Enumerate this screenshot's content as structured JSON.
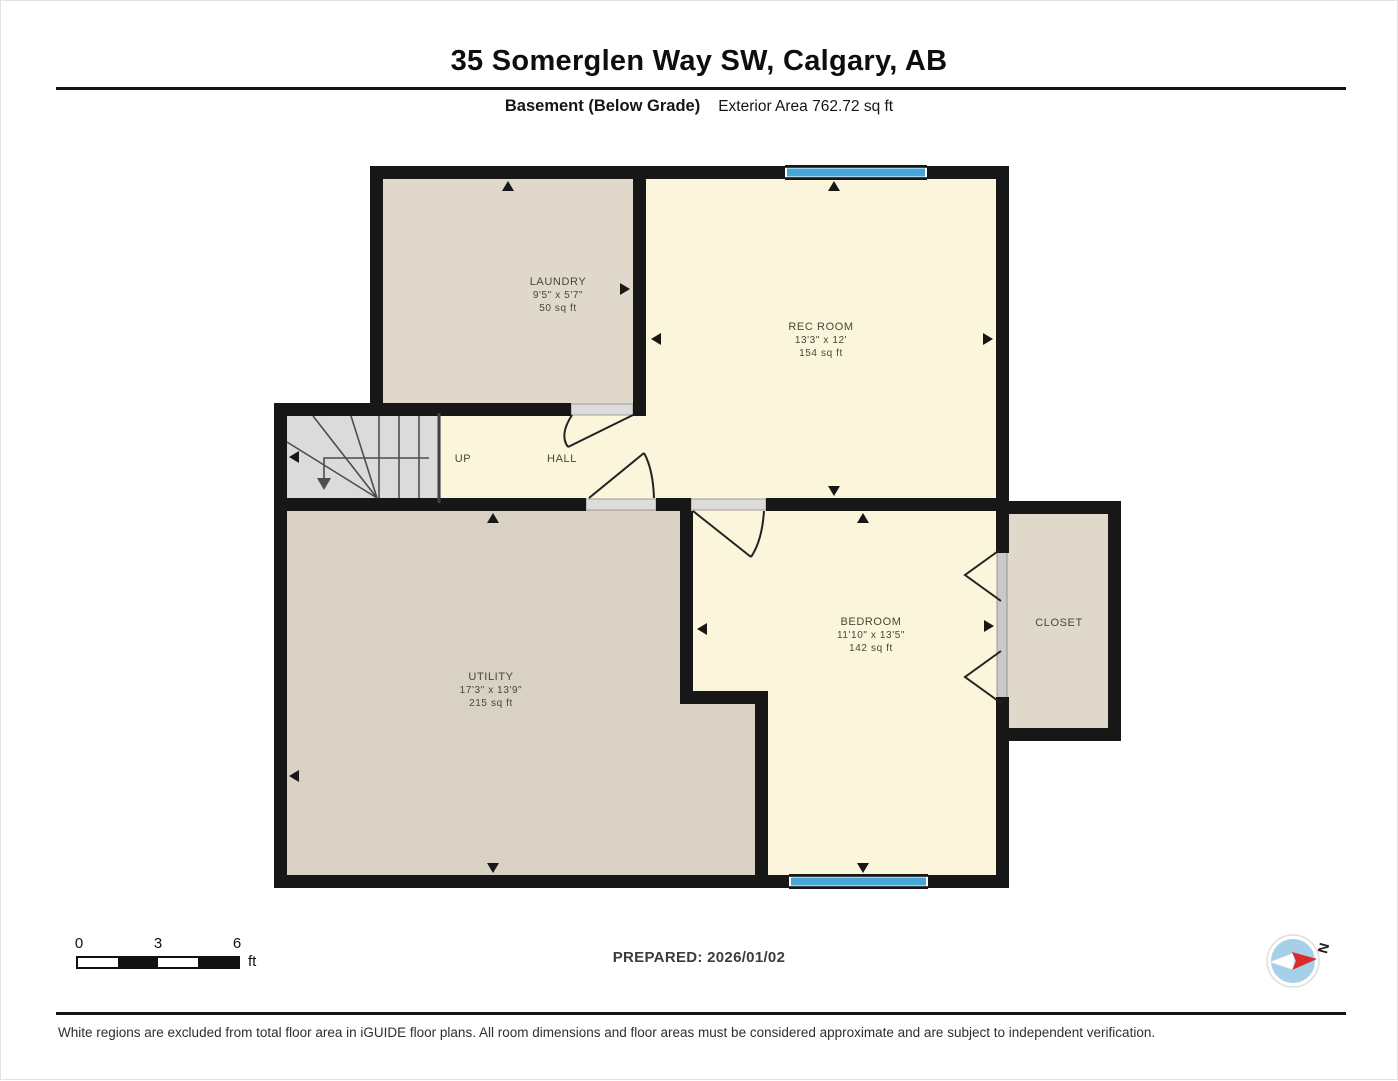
{
  "header": {
    "title": "35 Somerglen Way SW, Calgary, AB",
    "floor_label": "Basement (Below Grade)",
    "area_label": "Exterior Area 762.72 sq ft"
  },
  "plan": {
    "rooms": {
      "laundry": {
        "name": "LAUNDRY",
        "dims": "9'5\" x 5'7\"",
        "area": "50 sq ft"
      },
      "rec_room": {
        "name": "REC ROOM",
        "dims": "13'3\" x 12'",
        "area": "154 sq ft"
      },
      "utility": {
        "name": "UTILITY",
        "dims": "17'3\" x 13'9\"",
        "area": "215 sq ft"
      },
      "bedroom": {
        "name": "BEDROOM",
        "dims": "11'10\" x 13'5\"",
        "area": "142 sq ft"
      },
      "closet": {
        "name": "CLOSET"
      },
      "hall": {
        "name": "HALL"
      },
      "stair_direction": {
        "name": "UP"
      }
    }
  },
  "scale_bar": {
    "tick_0": "0",
    "tick_3": "3",
    "tick_6": "6",
    "unit": "ft"
  },
  "prepared_label": "PREPARED: 2026/01/02",
  "compass": {
    "north_label": "N"
  },
  "disclaimer": "White regions are excluded from total floor area in iGUIDE floor plans. All room dimensions and floor areas must be considered approximate and are subject to independent verification.",
  "colors": {
    "wall": "#171717",
    "window_blue": "#46A5D9",
    "room_cream": "#FBF5DC",
    "room_tan": "#E0D9CB",
    "room_tan_dark": "#D9D1C3",
    "stairs_gray": "#DBDBDB"
  }
}
